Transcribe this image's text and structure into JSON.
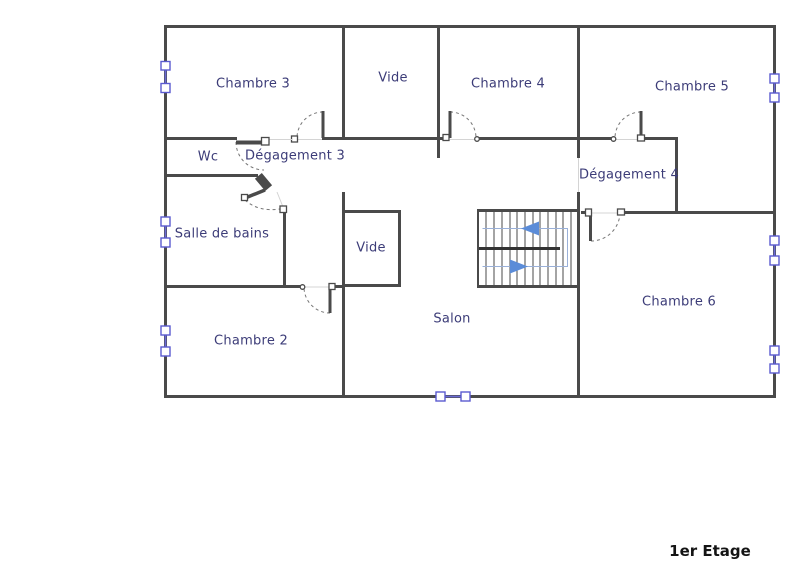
{
  "title": "1er Etage",
  "rooms": [
    {
      "id": "chambre-3",
      "label": "Chambre 3"
    },
    {
      "id": "vide-upper",
      "label": "Vide"
    },
    {
      "id": "chambre-4",
      "label": "Chambre 4"
    },
    {
      "id": "chambre-5",
      "label": "Chambre 5"
    },
    {
      "id": "wc",
      "label": "Wc"
    },
    {
      "id": "degagement-3",
      "label": "Dégagement 3"
    },
    {
      "id": "degagement-4",
      "label": "Dégagement 4"
    },
    {
      "id": "salle-de-bains",
      "label": "Salle de bains"
    },
    {
      "id": "vide-lower",
      "label": "Vide"
    },
    {
      "id": "salon",
      "label": "Salon"
    },
    {
      "id": "chambre-2",
      "label": "Chambre 2"
    },
    {
      "id": "chambre-6",
      "label": "Chambre 6"
    }
  ],
  "stairs": {
    "upper_flight_arrow": "left",
    "lower_flight_arrow": "right"
  },
  "counts": {
    "windows": 7,
    "doors": 7
  },
  "colors": {
    "wall": "#4a4a4a",
    "room_label": "#3c3c78",
    "window": "#5a5ad0",
    "stair_guide": "#9ab0d8",
    "stair_arrow": "#5b8cd8",
    "title": "#141414",
    "background": "#ffffff"
  }
}
